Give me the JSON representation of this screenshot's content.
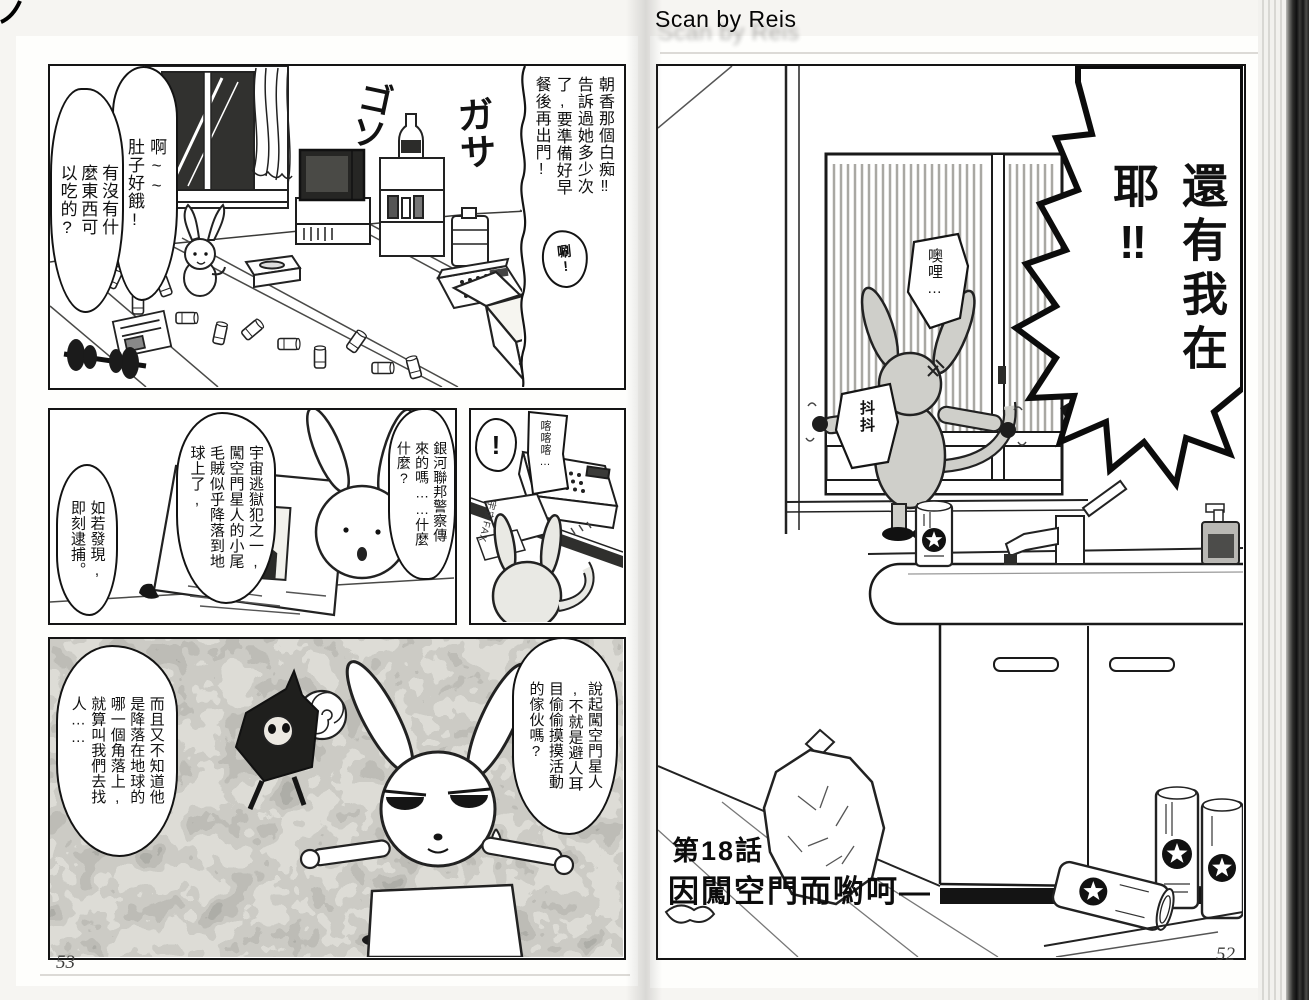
{
  "scan": {
    "credit": "Scan by Reis"
  },
  "left_page": {
    "page_number": "53",
    "panel_room": {
      "bubble_hungry_a": "啊~~\n肚子好餓!",
      "bubble_hungry_b": "有沒有什\n麼東西可\n以吃的?",
      "caption_asaka": "朝香那個白痴‼\n告訴過她多少次\n了,要準備好早\n餐後再出門!",
      "sfx_goso": "ゴソ",
      "sfx_gasa": "ガサ",
      "sfx_rustle": "唰!"
    },
    "panel_fax_read": {
      "bubble_fugitive": "宇宙逃獄犯之一,\n闖空門星人的小尾\n毛賊似乎降落到地\n球上了,",
      "bubble_arrest": "如若發現,\n即刻逮捕。",
      "bubble_galaxy": "銀河聯邦警察傳\n來的嗎……什麼\n什麼?",
      "fax_header": "宇宙FAX",
      "sfx_para": "パラ"
    },
    "panel_fax_machine": {
      "sfx_exclaim": "!",
      "sfx_clatter": "喀喀喀…",
      "fax_side_label": "宇宙FAX"
    },
    "panel_chase": {
      "bubble_search": "而且又不知道他\n是降落在地球的\n哪一個角落上,\n就算叫我們去找\n人……",
      "bubble_sneak": "說起闖空門星人\n,不就是避人耳\n目偷偷摸摸活動\n的傢伙嗎?"
    }
  },
  "right_page": {
    "page_number": "52",
    "panel_bathroom": {
      "bubble_shout": "還有我在\n耶‼",
      "bubble_ori": "噢哩…",
      "sfx_tremble": "抖抖",
      "chapter_number": "第18話",
      "chapter_title": "因闖空門而喲呵—"
    }
  }
}
